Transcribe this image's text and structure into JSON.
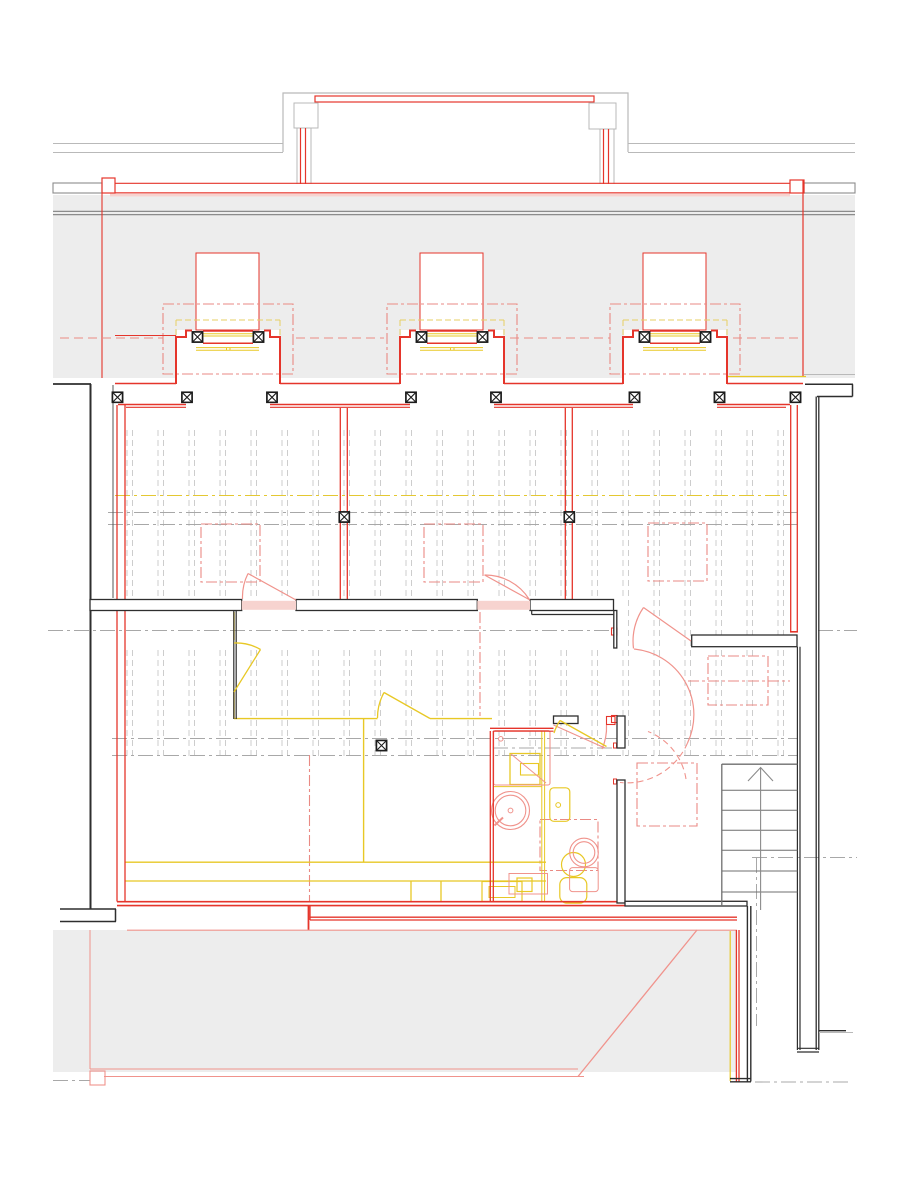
{
  "drawing": {
    "kind": "architectural-floor-plan",
    "view": "plan",
    "canvas": {
      "width_px": 907,
      "height_px": 1177
    },
    "visible_text": []
  },
  "colors": {
    "red": "#e5352b",
    "pink": "#f0938c",
    "pink_fill": "#f7d3cf",
    "demo_red": "#ea8a84",
    "yellow": "#e8c825",
    "yellow_pale": "#e7cf63",
    "yellow_cl": "#e4c832",
    "black": "#2e2e2e",
    "gray_line": "#b9b9b9",
    "gray_dark": "#8c8c8c",
    "gray_fill": "#ededed",
    "stair_gray": "#6f6f6f",
    "centerline": "#a8a8a8",
    "joist_gray": "#cdcdcd"
  },
  "layers": [
    {
      "id": "existing-structure",
      "color_key": "black",
      "style": "solid"
    },
    {
      "id": "new-construction",
      "color_key": "red",
      "style": "solid"
    },
    {
      "id": "demolition",
      "color_key": "demo_red",
      "style": "dash-dot"
    },
    {
      "id": "fixtures-services",
      "color_key": "yellow",
      "style": "solid"
    },
    {
      "id": "site-context",
      "color_key": "gray_line",
      "style": "solid"
    },
    {
      "id": "centerlines",
      "color_key": "centerline",
      "style": "dash-dot"
    },
    {
      "id": "floor-joists",
      "color_key": "joist_gray",
      "style": "dashed"
    }
  ],
  "symbols": {
    "column_marker": {
      "glyph": "crossed-square",
      "count": 17
    },
    "window_bays": {
      "count": 3
    },
    "door_swings": {
      "count": 7
    }
  },
  "stair": {
    "tread_lines": 6,
    "direction": "up"
  }
}
